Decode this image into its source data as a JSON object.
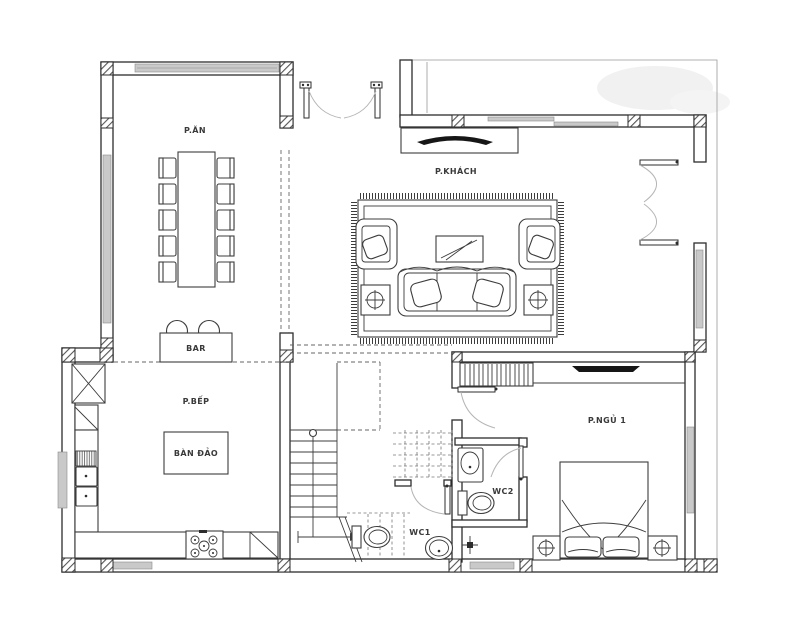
{
  "plan": {
    "background": "#ffffff",
    "line_color": "#2d2d2d",
    "glass_color": "#c9c9c9",
    "label_color": "#3a3a3a",
    "rooms": {
      "dining": "P.ĂN",
      "living": "P.KHÁCH",
      "kitchen": "P.BẾP",
      "kitchen_island": "BÀN ĐẢO",
      "bar": "BAR",
      "bedroom": "P.NGỦ 1",
      "wc1": "WC1",
      "wc2": "WC2"
    }
  }
}
